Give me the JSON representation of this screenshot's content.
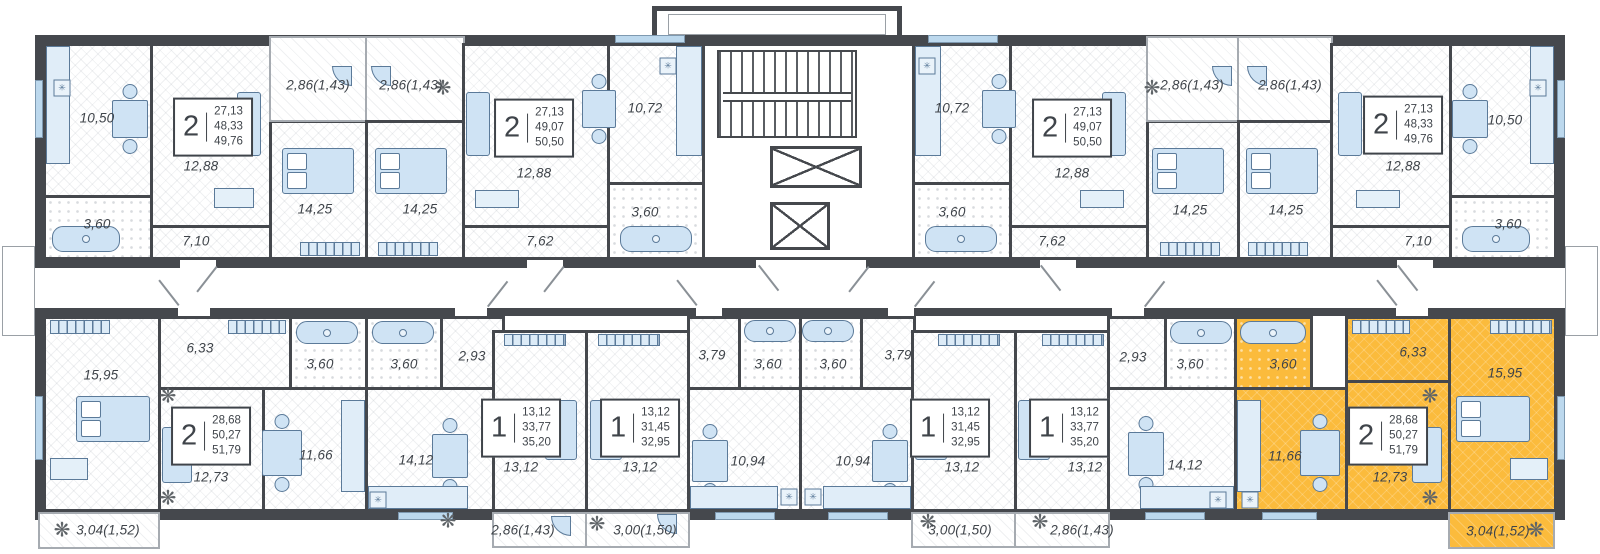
{
  "plan": {
    "highlight_color": "#FBBB3C",
    "wall_color": "#45484D",
    "furniture_color": "#CFE3F4",
    "furniture_line_color": "#5B7A99"
  },
  "icons": {
    "plant": "❋",
    "vent": "✳"
  },
  "apartments": {
    "t1": {
      "rooms_count": "2",
      "living_area": "27,13",
      "area": "48,33",
      "total_area": "49,76",
      "rooms": {
        "kitchen": "10,50",
        "bath": "3,60",
        "living": "12,88",
        "hall": "7,10",
        "bedroom": "14,25",
        "balcony": "2,86(1,43)"
      }
    },
    "t2": {
      "rooms_count": "2",
      "living_area": "27,13",
      "area": "49,07",
      "total_area": "50,50",
      "rooms": {
        "balcony": "2,86(1,43)",
        "bedroom": "14,25",
        "living": "12,88",
        "hall": "7,62",
        "bath": "3,60",
        "kitchen": "10,72"
      }
    },
    "t3": {
      "rooms_count": "2",
      "living_area": "27,13",
      "area": "49,07",
      "total_area": "50,50",
      "rooms": {
        "balcony": "2,86(1,43)",
        "bedroom": "14,25",
        "living": "12,88",
        "hall": "7,62",
        "bath": "3,60",
        "kitchen": "10,72"
      }
    },
    "t4": {
      "rooms_count": "2",
      "living_area": "27,13",
      "area": "48,33",
      "total_area": "49,76",
      "rooms": {
        "kitchen": "10,50",
        "bath": "3,60",
        "living": "12,88",
        "hall": "7,10",
        "bedroom": "14,25",
        "balcony": "2,86(1,43)"
      }
    },
    "b1": {
      "rooms_count": "2",
      "living_area": "28,68",
      "area": "50,27",
      "total_area": "51,79",
      "rooms": {
        "bedroom": "15,95",
        "hall": "6,33",
        "bath": "3,60",
        "living": "12,73",
        "kitchen": "11,66",
        "balcony": "3,04(1,52)"
      }
    },
    "b2": {
      "rooms_count": "1",
      "living_area": "13,12",
      "area": "33,77",
      "total_area": "35,20",
      "rooms": {
        "bath": "3,60",
        "hall": "2,93",
        "kitchen": "14,12",
        "living": "13,12",
        "balcony": "2,86(1,43)"
      }
    },
    "b3": {
      "rooms_count": "1",
      "living_area": "13,12",
      "area": "31,45",
      "total_area": "32,95",
      "rooms": {
        "living": "13,12",
        "balcony": "3,00(1,50)",
        "hall": "3,79",
        "bath": "3,60",
        "kitchen": "10,94"
      }
    },
    "b4": {
      "rooms_count": "1",
      "living_area": "13,12",
      "area": "31,45",
      "total_area": "32,95",
      "rooms": {
        "living": "13,12",
        "balcony": "3,00(1,50)",
        "hall": "3,79",
        "bath": "3,60",
        "kitchen": "10,94"
      }
    },
    "b5": {
      "rooms_count": "1",
      "living_area": "13,12",
      "area": "33,77",
      "total_area": "35,20",
      "rooms": {
        "bath": "3,60",
        "hall": "2,93",
        "kitchen": "14,12",
        "living": "13,12",
        "balcony": "2,86(1,43)"
      }
    },
    "b6": {
      "highlighted": true,
      "rooms_count": "2",
      "living_area": "28,68",
      "area": "50,27",
      "total_area": "51,79",
      "rooms": {
        "bath": "3,60",
        "kitchen": "11,66",
        "hall": "6,33",
        "living": "12,73",
        "bedroom": "15,95",
        "balcony": "3,04(1,52)"
      }
    }
  }
}
